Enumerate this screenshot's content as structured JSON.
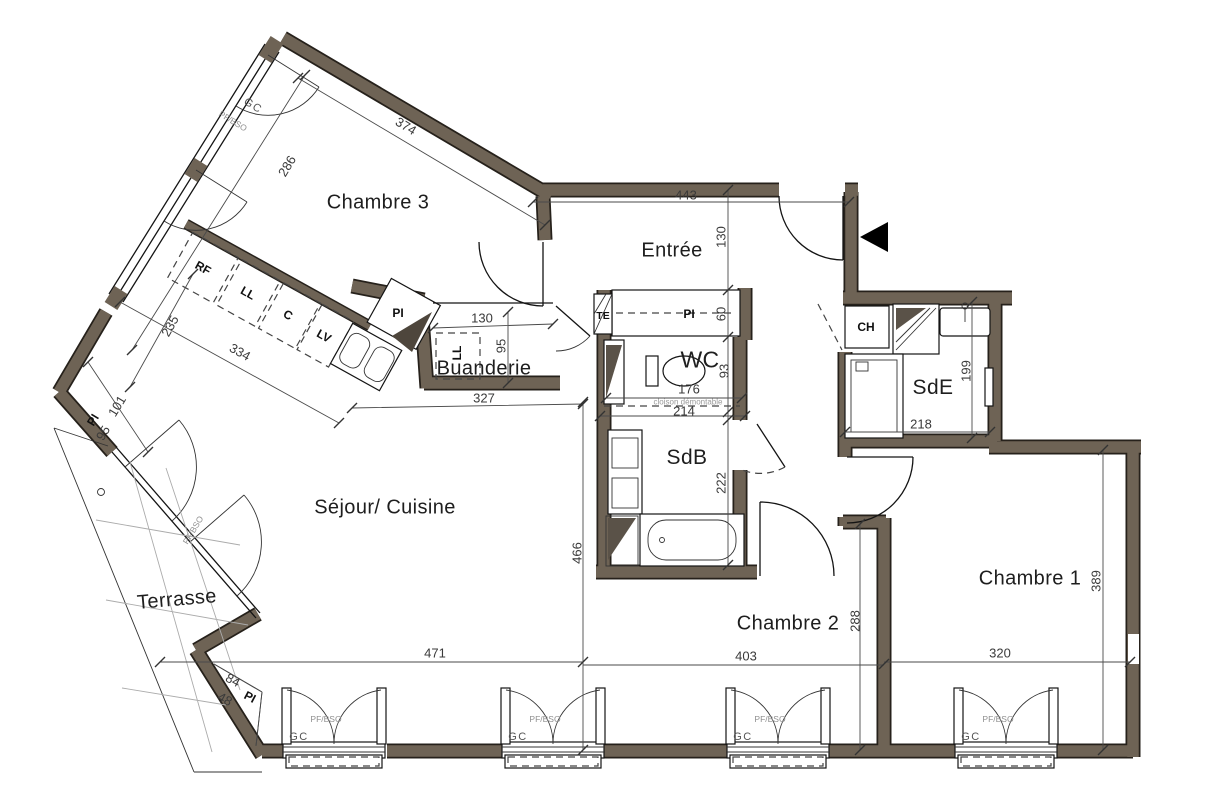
{
  "meta": {
    "type": "architectural-floor-plan"
  },
  "rooms": {
    "chambre3": "Chambre 3",
    "entree": "Entrée",
    "buanderie": "Buanderie",
    "wc": "WC",
    "sde": "SdE",
    "sdb": "SdB",
    "sejour": "Séjour/ Cuisine",
    "terrasse": "Terrasse",
    "chambre2": "Chambre 2",
    "chambre1": "Chambre 1"
  },
  "fixtures": {
    "rf": "RF",
    "ll_kitchen": "LL",
    "cooktop": "C",
    "lv": "LV",
    "pi_kitchen": "PI",
    "pi_hall": "PI",
    "te": "TE",
    "ch": "CH",
    "ll_buanderie": "LL",
    "pi_left": "PI",
    "pi_corner": "PI"
  },
  "dims": {
    "d374": "374",
    "d286": "286",
    "d443": "443",
    "d130_entree": "130",
    "d60": "60",
    "d130_buanderie": "130",
    "d95_buanderie": "95",
    "d327": "327",
    "d334": "334",
    "d235": "235",
    "d101": "101",
    "d95_pi": "95",
    "d176": "176",
    "d93": "93",
    "d214": "214",
    "d222": "222",
    "d466": "466",
    "d471": "471",
    "d403": "403",
    "d288": "288",
    "d320": "320",
    "d389": "389",
    "d199": "199",
    "d218": "218",
    "d84": "84",
    "d48": "48"
  },
  "annotations": {
    "cloison": "cloison démontable",
    "window_label": "PF/BSO",
    "guardrail": "GC"
  },
  "colors": {
    "wall": "#6E6355",
    "line": "#141414",
    "dim_text": "#3A3A3A",
    "terrace_grid": "#ABABAB"
  }
}
